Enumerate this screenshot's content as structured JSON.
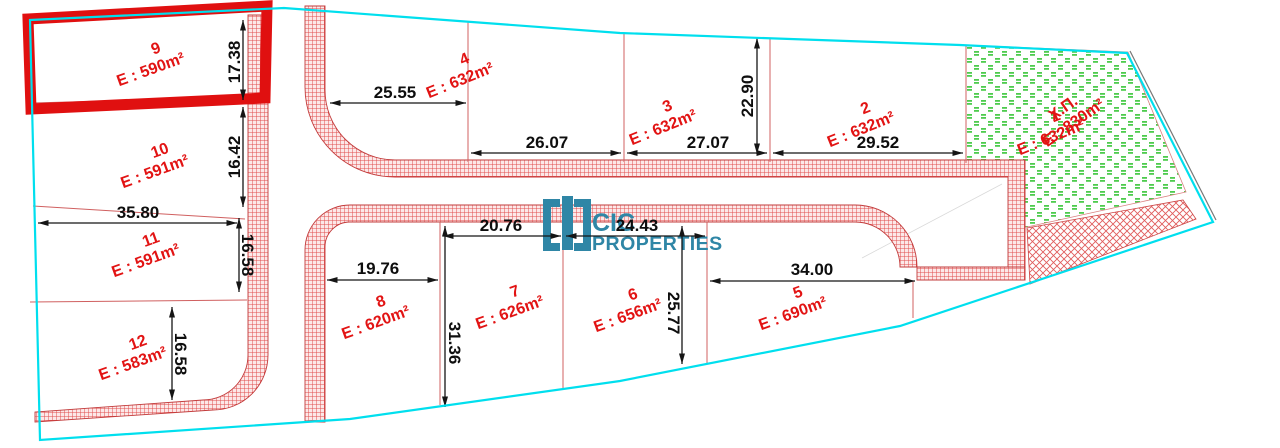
{
  "plan": {
    "type": "land-subdivision-plan",
    "colors": {
      "boundary": "#00dfee",
      "road_hatch": "#e04e4e",
      "road_hatch_bg": "#fce8e8",
      "green_area": "#4ecb4e",
      "plot_label": "#e21313",
      "dimension_text": "#0e0e0e",
      "highlight_box": "#e01010",
      "logo": "#2f86a6",
      "divider": "#d06060"
    }
  },
  "logo": {
    "line1": "CIC",
    "line2": "PROPERTIES"
  },
  "green_area": {
    "name": "Χ.Π.",
    "area": "E : 830m²"
  },
  "plots": [
    {
      "id": "9",
      "area": "E : 590m²",
      "highlighted": true
    },
    {
      "id": "10",
      "area": "E : 591m²"
    },
    {
      "id": "11",
      "area": "E : 591m²"
    },
    {
      "id": "12",
      "area": "E : 583m²"
    },
    {
      "id": "4",
      "area": "E : 632m²"
    },
    {
      "id": "3",
      "area": "E : 632m²"
    },
    {
      "id": "2",
      "area": "E : 632m²"
    },
    {
      "id": "1",
      "area": "E : 632m²"
    },
    {
      "id": "8",
      "area": "E : 620m²"
    },
    {
      "id": "7",
      "area": "E : 626m²"
    },
    {
      "id": "6",
      "area": "E : 656m²"
    },
    {
      "id": "5",
      "area": "E : 690m²"
    }
  ],
  "dimensions": [
    {
      "value": "17.38"
    },
    {
      "value": "16.42"
    },
    {
      "value": "35.80"
    },
    {
      "value": "16.58"
    },
    {
      "value": "16.58"
    },
    {
      "value": "25.55"
    },
    {
      "value": "26.07"
    },
    {
      "value": "27.07"
    },
    {
      "value": "22.90"
    },
    {
      "value": "29.52"
    },
    {
      "value": "20.76"
    },
    {
      "value": "24.43"
    },
    {
      "value": "19.76"
    },
    {
      "value": "31.36"
    },
    {
      "value": "25.77"
    },
    {
      "value": "34.00"
    }
  ]
}
